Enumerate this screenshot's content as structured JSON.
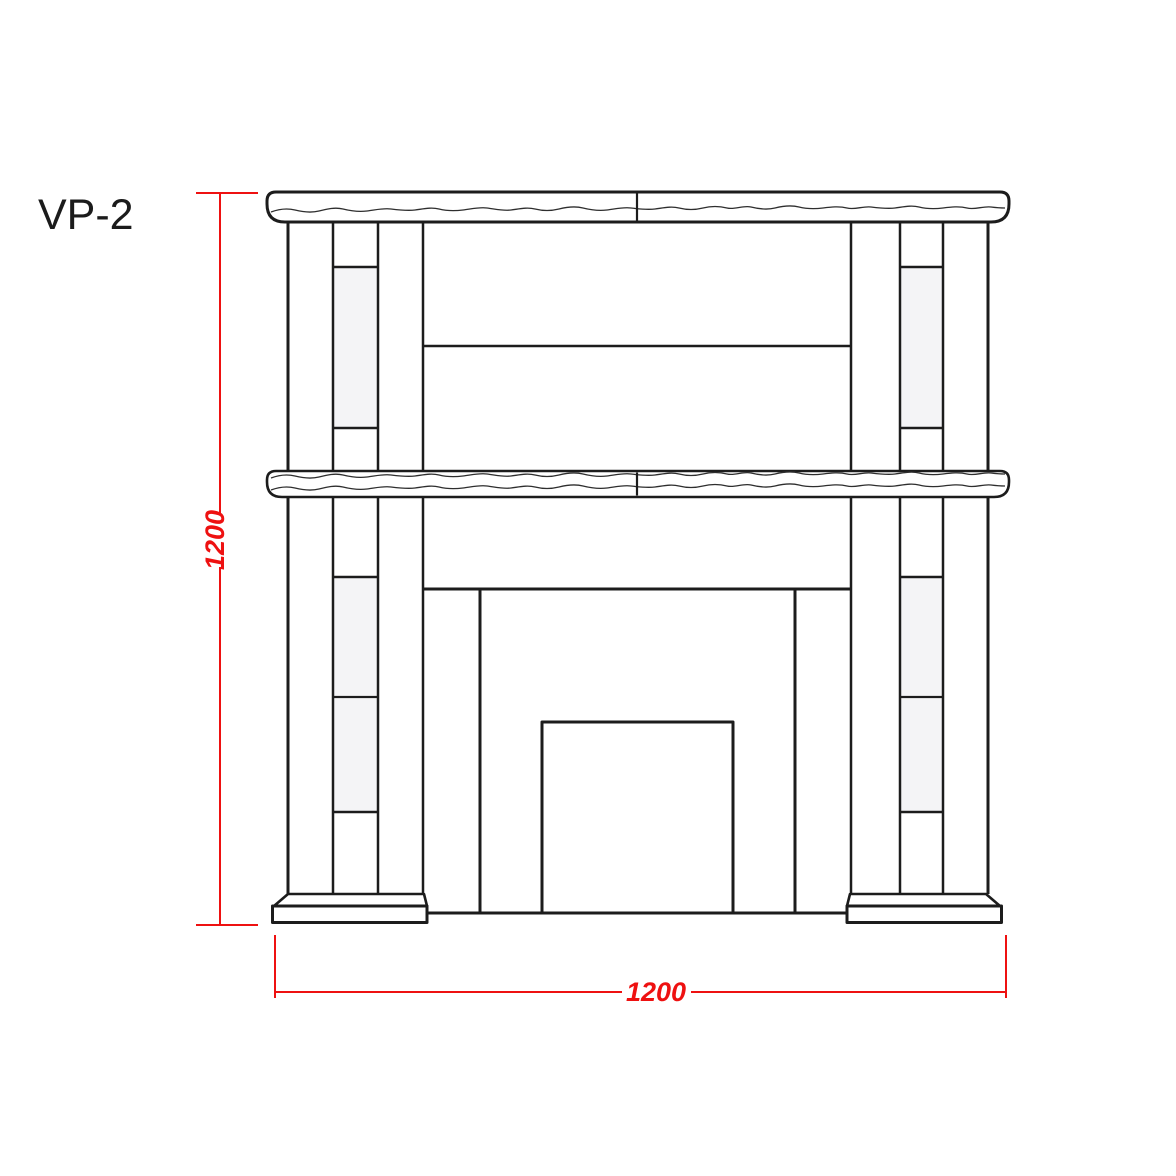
{
  "title": {
    "label": "VP-2"
  },
  "dimensions": {
    "height": {
      "value": "1200",
      "orientation": "vertical"
    },
    "width": {
      "value": "1200",
      "orientation": "horizontal"
    }
  },
  "colors": {
    "line": "#1c1c1c",
    "dimension": "#ee1111",
    "panel_fill": "#f4f4f6",
    "background": "#ffffff"
  }
}
